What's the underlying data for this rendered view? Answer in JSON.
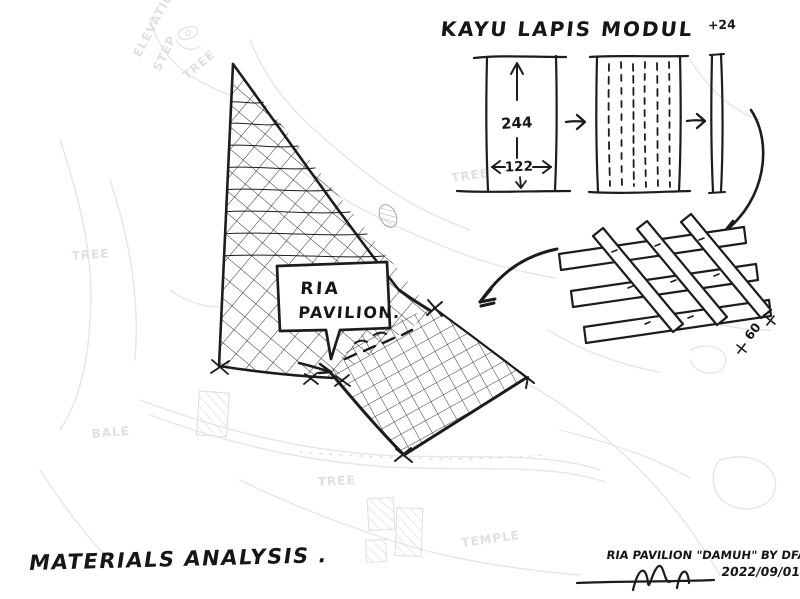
{
  "colors": {
    "ink": "#1c1c1c",
    "hatch": "#2e2e2e",
    "faint_background": "#e6e6e6",
    "paper": "#ffffff"
  },
  "module_diagram": {
    "title": "KAYU LAPIS MODUL",
    "thickness_label": "+24",
    "height_dim": "244",
    "width_dim": "122",
    "strip_length_label": "60"
  },
  "site_plan": {
    "bubble_line1": "RIA",
    "bubble_line2": "PAVILION."
  },
  "faint_labels": [
    "ELEVATION",
    "STEP",
    "TREE",
    "TREE",
    "SITE AREA",
    "TREE",
    "BALE",
    "TREE",
    "TEMPLE"
  ],
  "footer": {
    "title": "MATERIALS ANALYSIS .",
    "credit": "RIA PAVILION \"DAMUH\" BY DFAP .",
    "date": "2022/09/01"
  }
}
